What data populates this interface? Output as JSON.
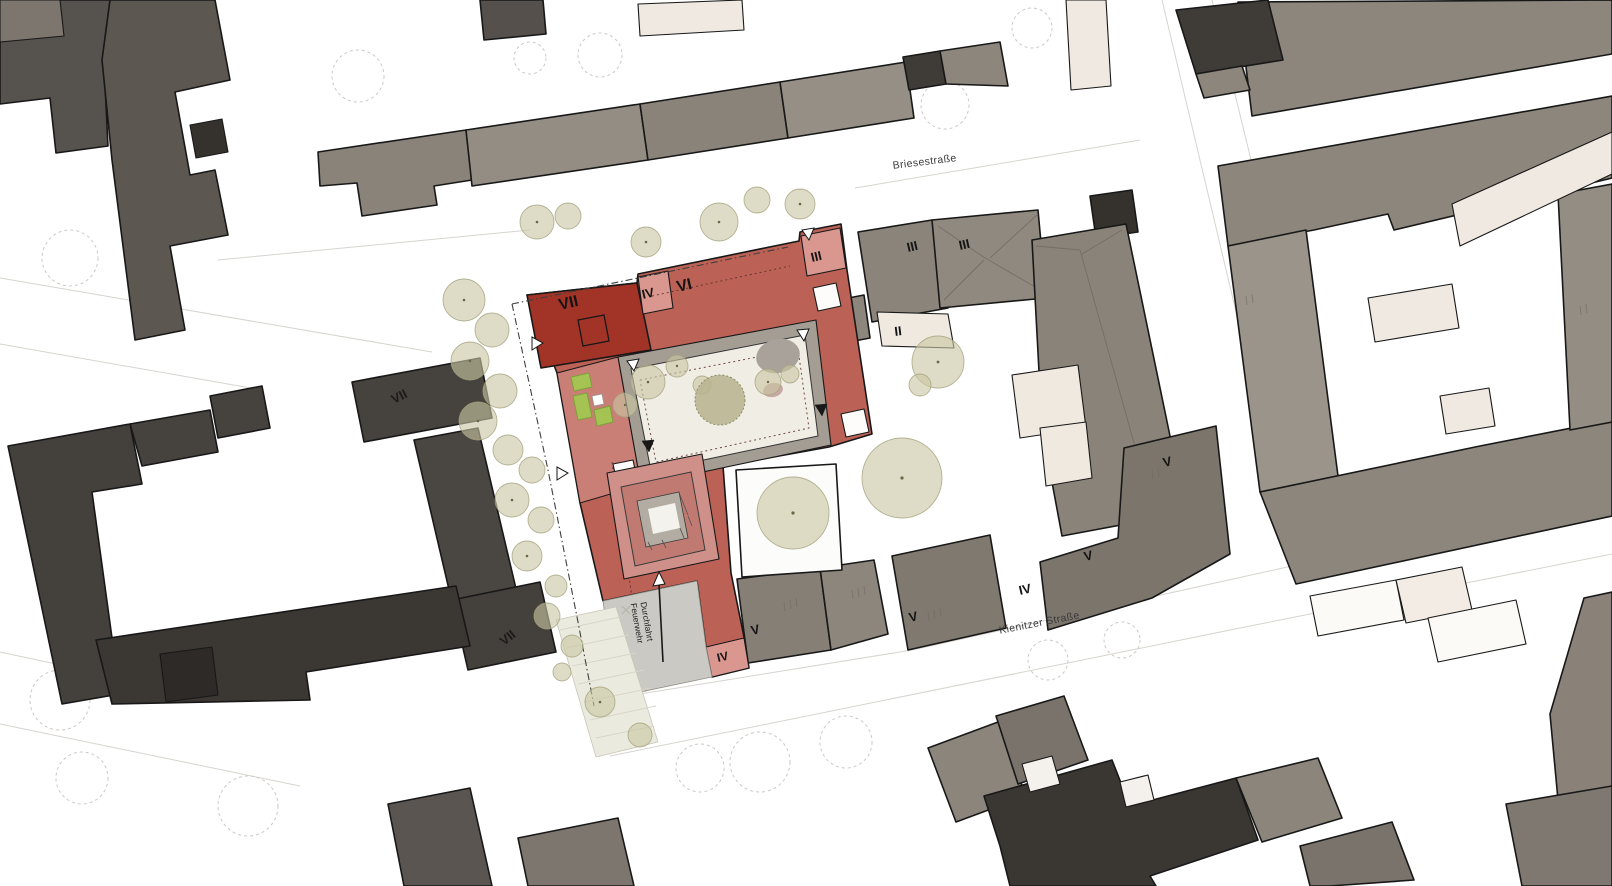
{
  "title": "Urban site plan with highlighted new building complex",
  "map": {
    "streets": [
      {
        "name": "Briesestraße"
      },
      {
        "name": "Kienitzer Straße"
      }
    ],
    "fire_lane": {
      "line1": "Durchfahrt",
      "line2": "Feuerwehr"
    },
    "floor_labels": [
      {
        "text": "VII"
      },
      {
        "text": "IV"
      },
      {
        "text": "VI"
      },
      {
        "text": "III"
      },
      {
        "text": "III"
      },
      {
        "text": "III"
      },
      {
        "text": "II"
      },
      {
        "text": "V"
      },
      {
        "text": "V"
      },
      {
        "text": "IV"
      },
      {
        "text": "V"
      },
      {
        "text": "V"
      },
      {
        "text": "IV"
      },
      {
        "text": "VII"
      },
      {
        "text": "VII"
      }
    ],
    "colors": {
      "site_red_dark": "#a23327",
      "site_red_mid": "#bc6156",
      "site_red_light": "#d9978f",
      "site_red_band": "#c97e76",
      "atrium_pink": "#d0908a",
      "courtyard_deck": "#a39d94",
      "courtyard_floor": "#f0ede5",
      "context_dark": "#44403c",
      "context_gray": "#8d867d",
      "context_cream": "#f0e9e1",
      "planter_green": "#a5c353",
      "tree_olive": "#cac7a3"
    }
  }
}
